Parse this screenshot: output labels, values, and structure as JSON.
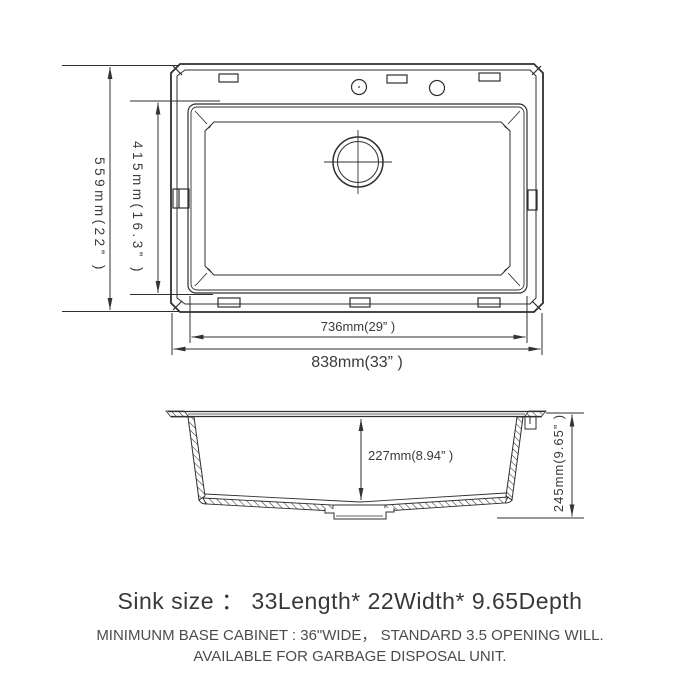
{
  "drawing": {
    "line_color": "#2f2f2f",
    "background": "#ffffff",
    "top_view": {
      "label_height_overall": "559mm(22” )",
      "label_height_inner": "415mm(16.3” )",
      "label_width_inner": "736mm(29” )",
      "label_width_overall": "838mm(33” )"
    },
    "side_view": {
      "label_depth_inner": "227mm(8.94” )",
      "label_depth_overall": "245mm(9.65” )"
    }
  },
  "caption": {
    "title": "Sink size ： 33Length* 22Width* 9.65Depth",
    "note_line1": "MINIMUNM BASE CABINET : 36\"WIDE，  STANDARD 3.5 OPENING WILL.",
    "note_line2": "AVAILABLE FOR GARBAGE DISPOSAL UNIT."
  }
}
